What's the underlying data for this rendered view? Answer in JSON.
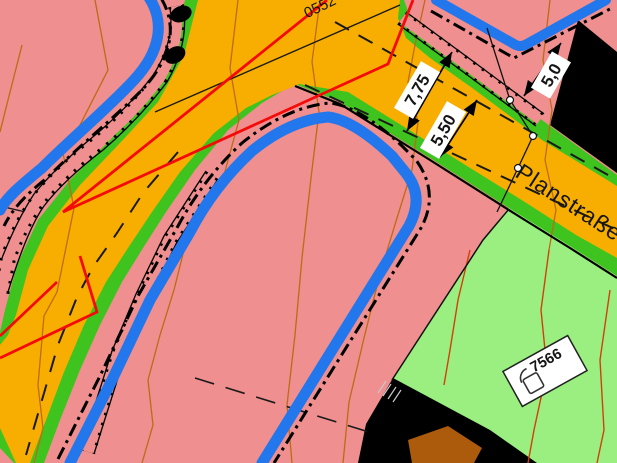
{
  "street": {
    "label": "Planstraße"
  },
  "labels": {
    "parcel_top": "0552",
    "parcel_green": "7566"
  },
  "dimensions": {
    "total_width": "7,75",
    "carriageway_width": "5,50",
    "setback": "5,0"
  },
  "colors": {
    "pink": "#EF8F8F",
    "road_orange": "#F8AE00",
    "verge_green": "#3FC31F",
    "meadow_green": "#9AEF80",
    "boundary_blue": "#2277EC",
    "red_line": "#F50A0A",
    "black": "#000000",
    "brown": "#AC5A0C",
    "contour_brown": "#BD6B15",
    "contour_red": "#D2400A",
    "white": "#FFFFFF"
  }
}
